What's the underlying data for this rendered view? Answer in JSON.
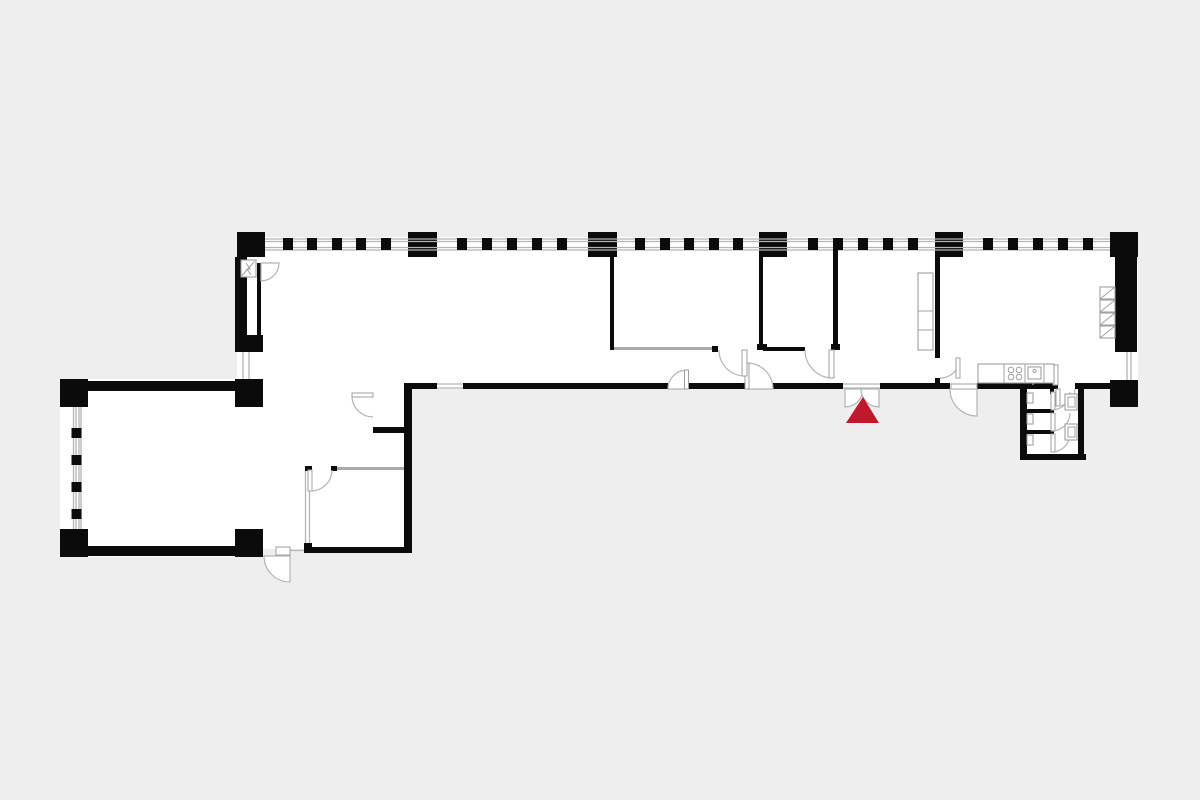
{
  "colors": {
    "background": "#eeeeee",
    "floor": "#ffffff",
    "wall": "#0b0b0b",
    "line": "#b4b4b4",
    "door": "#b4b4b4",
    "fixture": "#a0a0a0",
    "marker": "#c0192b"
  },
  "marker": {
    "icon": "entrance-marker",
    "shape": "triangle-up",
    "color": "#c0192b"
  },
  "symbols": [
    "structural-column",
    "window-mullion",
    "door-swing",
    "double-entrance-door",
    "shaft-symbol",
    "wardrobe",
    "kitchen-counter",
    "stove-burners",
    "sink",
    "appliance-stack",
    "wc-stall",
    "toilet"
  ]
}
